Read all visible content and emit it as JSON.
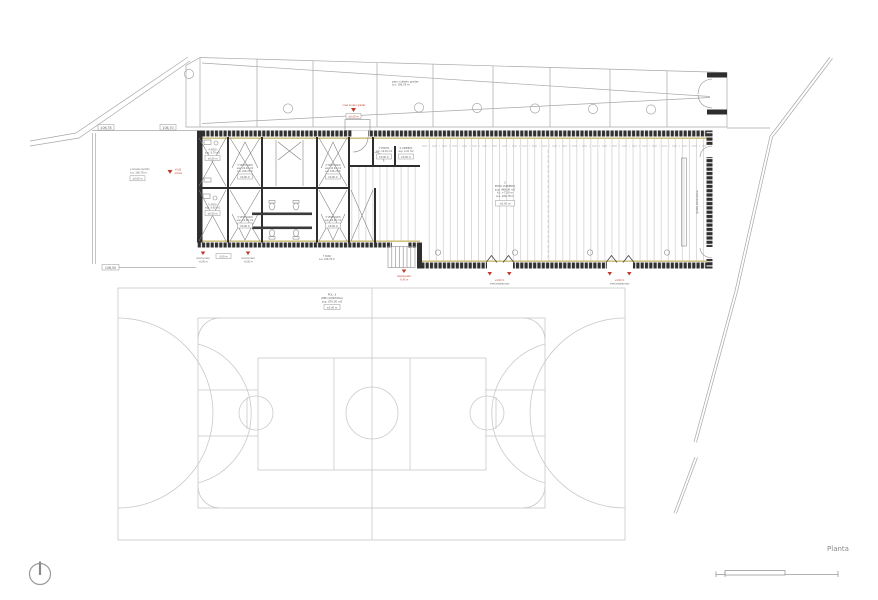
{
  "drawing": {
    "title": "Planta",
    "type_note": "architectural site / floor plan with sports court"
  },
  "colors": {
    "red_marker": "#c0392b",
    "tan_layer": "#c9ba6e",
    "wall_dark": "#303030",
    "line_gray": "#a8a8a8",
    "court_gray": "#c9c9c9"
  },
  "labels": {
    "planta": "Planta",
    "dim_top_a": "106,78",
    "dim_top_b": "106,70",
    "dim_left": "106,50",
    "access": [
      "y acceso recinto",
      "a.a. 106,78 m"
    ],
    "access_box": "±0,00 m",
    "access_red": [
      "+0,00",
      "acceso"
    ],
    "strip_note": [
      "paso cubierto gradas",
      "a.a. 106,78 m"
    ],
    "strip_red": "nivel acceso gradas",
    "strip_box": "±0,00 m",
    "aseo1": [
      "4  ASEO",
      "sup. 8,70 m2"
    ],
    "aseo1_box": "±0,00 m",
    "vest1": [
      "3  VESTUARIO",
      "sup. 22,40 m2",
      "a.a. 106,78 m"
    ],
    "vest1_box": "±0,00 m",
    "vest2": [
      "3  VESTUARIO",
      "sup. 22,40 m2",
      "a.a. 106,78 m"
    ],
    "vest2_box": "±0,00 m",
    "aseo2": [
      "5  ASEO",
      "sup. 9,60 m2"
    ],
    "aseo2_box": "±0,00 m",
    "vest3": [
      "3  VESTUARIO",
      "sup. 22,40 m2"
    ],
    "vest3_box": "±0,00 m",
    "vest4": [
      "3  VESTUARIO",
      "sup. 22,40 m2"
    ],
    "vest4_box": "±0,00 m",
    "vestibulo": [
      "1  VESTIB.",
      "sup. 14,20 m2"
    ],
    "vestibulo_box": "±0,00 m",
    "limpieza": [
      "6  LIMPIEZA",
      "sup. 4,10 m2"
    ],
    "limpieza_box": "±0,00 m",
    "paso": [
      "7  PASO",
      "a.a. 106,78 m"
    ],
    "hall": [
      "2",
      "PISTA CUBIERTA",
      "sup. 968,00 m2",
      "h.l. +7,50 m",
      "a.a. 106,78 m"
    ],
    "hall_box": "±0,00 m",
    "door1": [
      "+0,00 m",
      "nivel pista/acceso"
    ],
    "door2": [
      "+0,00 m",
      "nivel pista/acceso"
    ],
    "m1": [
      "nivel acceso",
      "+0,00 m"
    ],
    "m1_box": "0,00 m",
    "m2": [
      "nivel acceso",
      "+0,00 m"
    ],
    "stair_red": [
      "bajada pista",
      "-0,45 m"
    ],
    "court": [
      "POL.-2",
      "(RED GUNITADA)",
      "sup. 870,00 m2"
    ],
    "court_box": "±0,00 m",
    "bleacher": "grada telescopica"
  }
}
